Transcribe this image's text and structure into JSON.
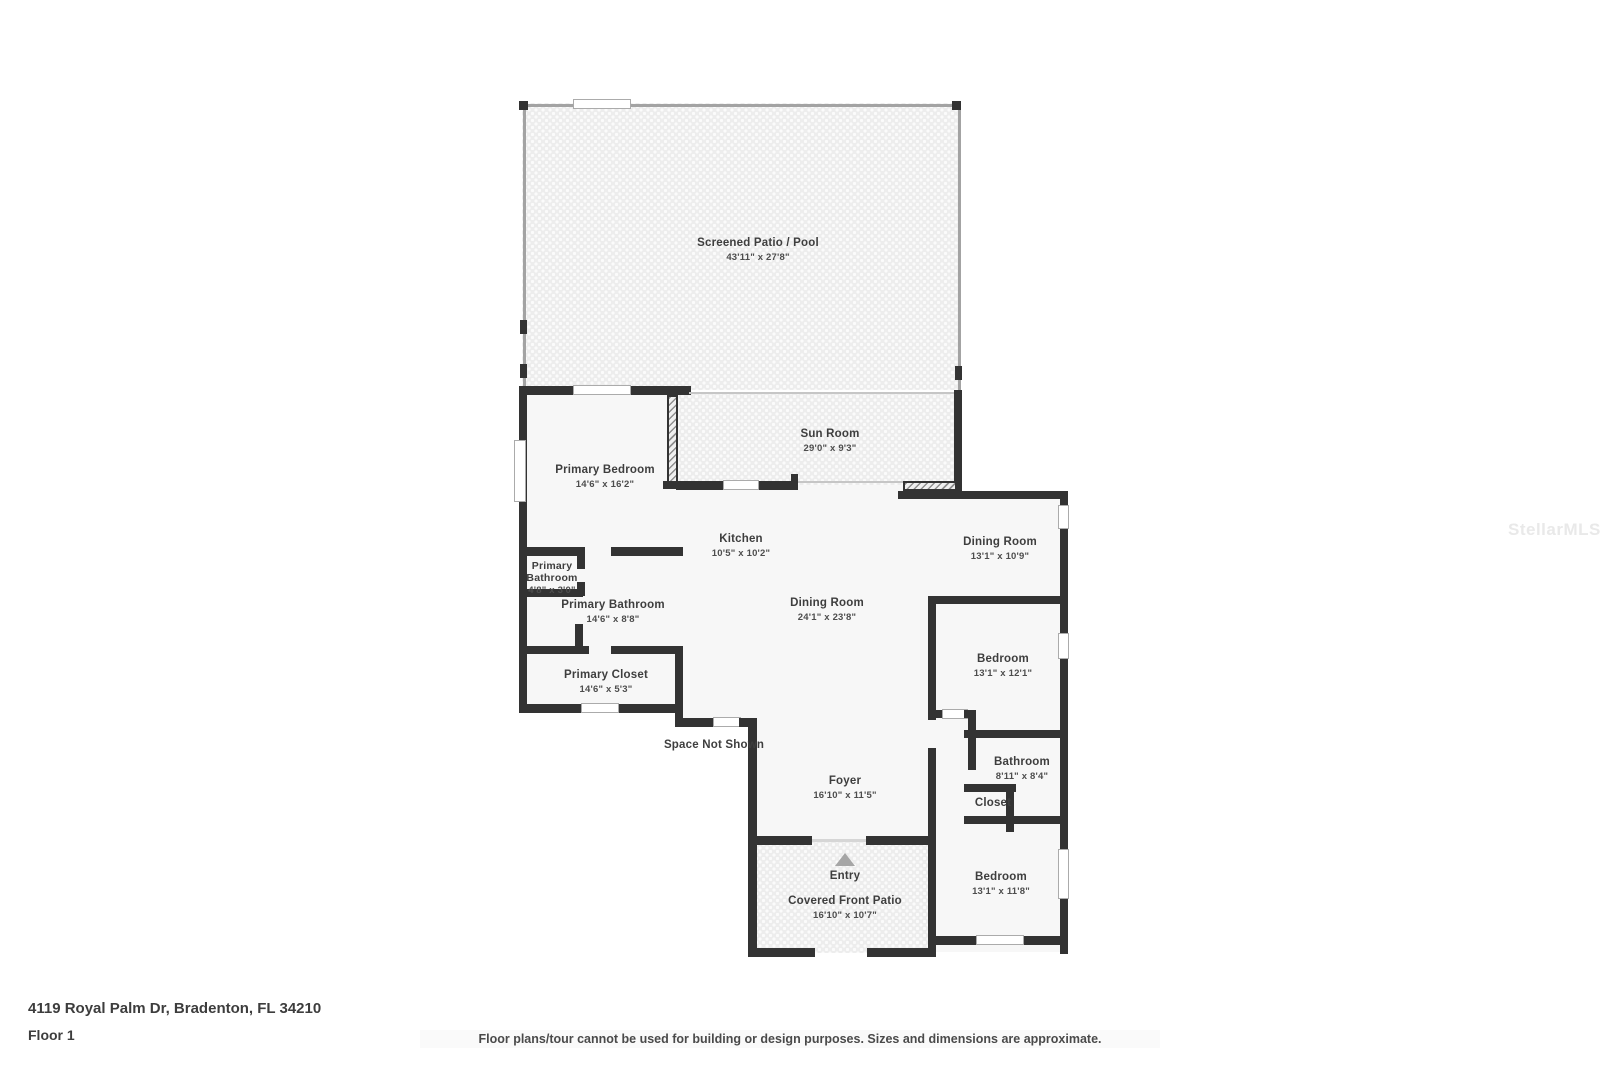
{
  "watermark": "StellarMLS",
  "footer": {
    "address": "4119 Royal Palm Dr, Bradenton, FL 34210",
    "floor_label": "Floor 1",
    "disclaimer": "Floor plans/tour cannot be used for building or design purposes. Sizes and dimensions are approximate."
  },
  "plan": {
    "colors": {
      "wall": "#333333",
      "screen_wall": "#a3a3a3",
      "room_fill": "#f7f7f7",
      "patio_fill": "#ededed",
      "label_text": "#3e3e3e",
      "watermark_text": "#e9e9e9"
    },
    "rooms": {
      "screened_patio": {
        "name": "Screened Patio / Pool",
        "dims": "43'11\" x 27'8\""
      },
      "sun_room": {
        "name": "Sun Room",
        "dims": "29'0\" x 9'3\""
      },
      "primary_bedroom": {
        "name": "Primary Bedroom",
        "dims": "14'6\" x 16'2\""
      },
      "kitchen": {
        "name": "Kitchen",
        "dims": "10'5\" x 10'2\""
      },
      "dining_room_right": {
        "name": "Dining Room",
        "dims": "13'1\" x 10'9\""
      },
      "dining_room_main": {
        "name": "Dining Room",
        "dims": "24'1\" x 23'8\""
      },
      "primary_bathroom_small": {
        "name": "Primary Bathroom",
        "dims": "4'8\" x 3'0\""
      },
      "primary_bathroom": {
        "name": "Primary Bathroom",
        "dims": "14'6\" x 8'8\""
      },
      "primary_closet": {
        "name": "Primary Closet",
        "dims": "14'6\" x 5'3\""
      },
      "bedroom_mid": {
        "name": "Bedroom",
        "dims": "13'1\" x 12'1\""
      },
      "bathroom": {
        "name": "Bathroom",
        "dims": "8'11\" x 8'4\""
      },
      "closet": {
        "name": "Closet"
      },
      "bedroom_lower": {
        "name": "Bedroom",
        "dims": "13'1\" x 11'8\""
      },
      "foyer": {
        "name": "Foyer",
        "dims": "16'10\" x 11'5\""
      },
      "entry": {
        "name": "Entry"
      },
      "covered_front_patio": {
        "name": "Covered Front Patio",
        "dims": "16'10\" x 10'7\""
      },
      "space_not_shown": {
        "name": "Space Not Shown"
      }
    }
  }
}
